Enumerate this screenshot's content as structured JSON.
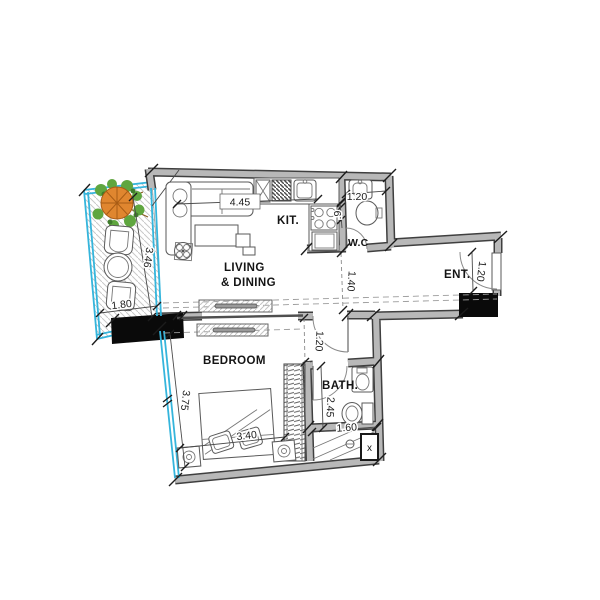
{
  "rooms": {
    "living1": "LIVING",
    "living2": "& DINING",
    "kitchen": "KIT.",
    "wc": "W.C",
    "entrance": "ENT.",
    "bedroom": "BEDROOM",
    "bath": "BATH."
  },
  "dims": {
    "living_width": "4.45",
    "wc_width": "1.20",
    "wc_depth": ".9",
    "hall_width": "1.40",
    "ent_width": "1.20",
    "balcony_length": "3.46",
    "balcony_width": "1.80",
    "bedroom_door_width": "1.20",
    "bedroom_length": "3.75",
    "bed_width": "3.40",
    "bath_length": "2.45",
    "bath_width": "1.60"
  },
  "misc": {
    "shaft_mark": "x"
  },
  "colors": {
    "wall": "#b8b8b8",
    "wall_edge": "#3f3f3f",
    "glass": "#35b5dc",
    "column": "#0a0a0a",
    "hatch": "#c9c9c9",
    "canopy": "#e0862f",
    "canopy_line": "#a85c15",
    "leaf": "#5fa63f",
    "leaf_dark": "#3f7d2c"
  }
}
